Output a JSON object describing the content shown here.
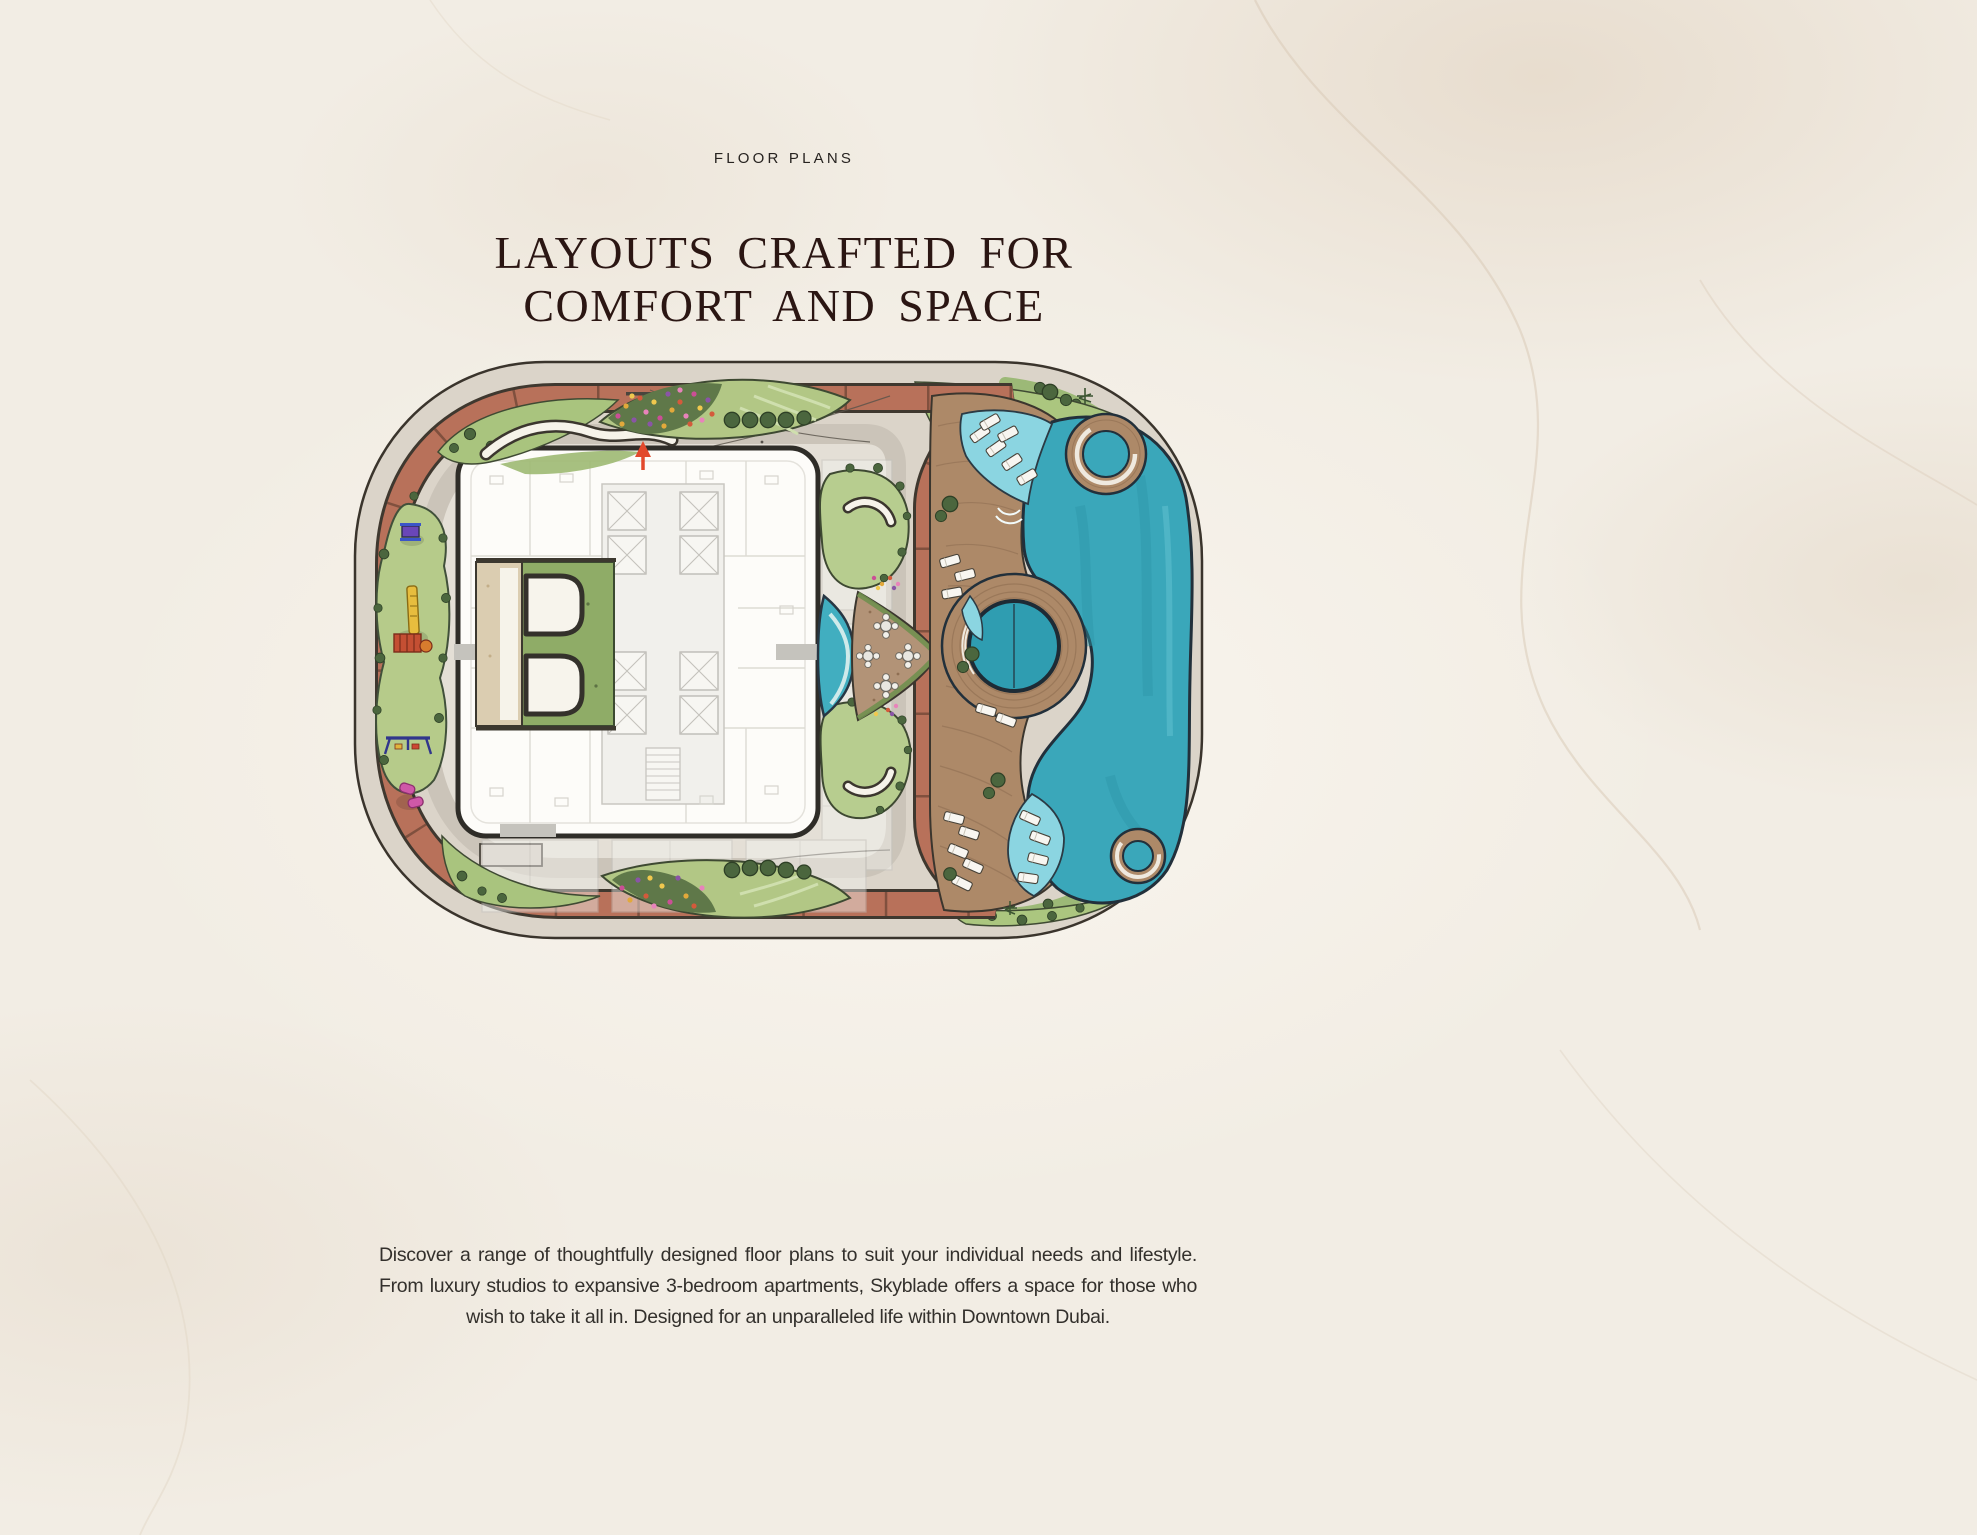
{
  "page": {
    "background": "#f2ede4"
  },
  "section": {
    "eyebrow": "FLOOR PLANS",
    "heading_line1": "LAYOUTS CRAFTED FOR",
    "heading_line2": "COMFORT AND SPACE",
    "description": "Discover a range of thoughtfully designed floor plans to suit your individual needs and lifestyle. From luxury studios to expansive 3-bedroom apartments, Skyblade offers a space for those who wish to take it all in. Designed for an unparalleled life within Downtown Dubai."
  },
  "site_plan": {
    "alt": "Hand-drawn amenity site plan of the podium deck with jogging track, gardens, tower floorplate, sun deck and leisure pool",
    "features": [
      "jogging-track",
      "kids-playground",
      "entrance-pavilion",
      "tower-floorplate",
      "flower-beds",
      "lawns",
      "seating-mounds",
      "outdoor-dining-deck",
      "lap-pool",
      "leisure-pool",
      "spa-circle",
      "wooden-sun-deck",
      "sun-loungers",
      "trees",
      "north-arrow"
    ],
    "colors": {
      "track": "#b8715a",
      "path": "#dbd4c9",
      "lawn": "#abc67f",
      "tree": "#4b663e",
      "pool": "#3aa7ba",
      "pool_shelf": "#8bd5e1",
      "wood_deck": "#ad8968",
      "building": "#fdfcf9",
      "accent_arrow": "#e2492c",
      "heading_text": "#2b1613",
      "body_text": "#33302c"
    }
  }
}
